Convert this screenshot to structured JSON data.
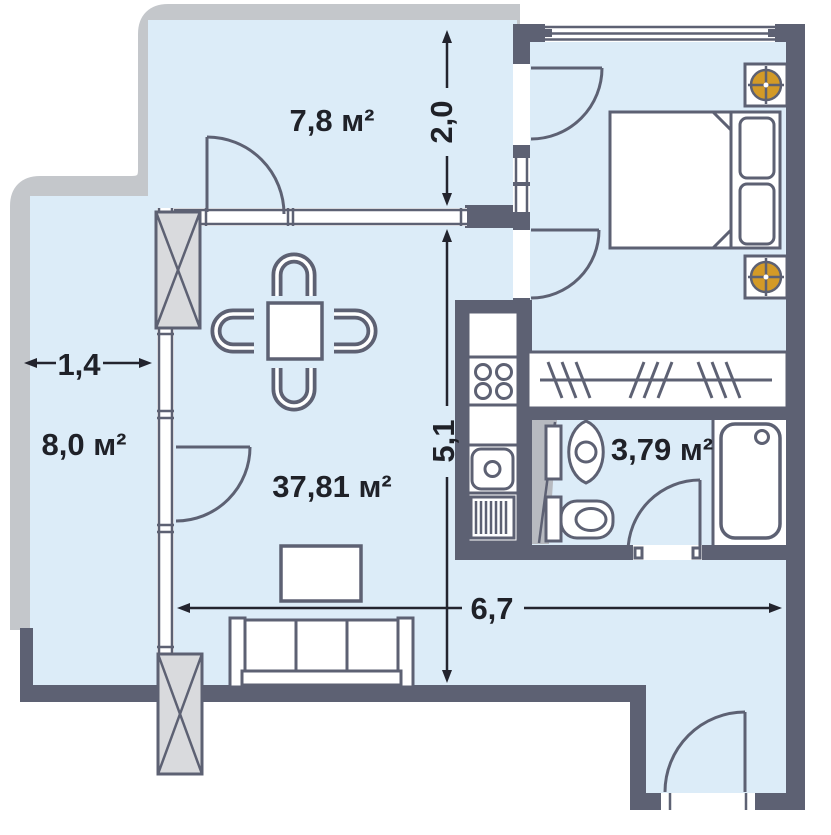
{
  "plan_title": "Apartment floor plan",
  "rooms": [
    {
      "id": "balcony-top",
      "label": "7,8 м²"
    },
    {
      "id": "balcony-left",
      "label": "8,0 м²"
    },
    {
      "id": "living-room",
      "label": "37,81 м²"
    },
    {
      "id": "bathroom",
      "label": "3,79 м²"
    }
  ],
  "dimensions": [
    {
      "id": "balcony-left-width",
      "label": "1,4"
    },
    {
      "id": "balcony-top-depth",
      "label": "2,0"
    },
    {
      "id": "living-room-depth",
      "label": "5,1"
    },
    {
      "id": "living-room-width",
      "label": "6,7"
    }
  ],
  "furniture": [
    "dining-table",
    "chair",
    "sofa",
    "tv-stand",
    "double-bed",
    "pillows",
    "wardrobe-hangers",
    "kitchen-counter",
    "stove-4-burners",
    "kitchen-sink",
    "drainer",
    "washbasin",
    "toilet",
    "bathtub",
    "ventilation-fan",
    "structural-column",
    "balcony-door",
    "entrance-door"
  ],
  "colors": {
    "wall": "#5d6173",
    "floor": "#dcecf8",
    "balcony_outline": "#c4c7cb",
    "column_fill": "#d9dadd",
    "shaft_fill": "#b7bac0",
    "vent": "#d39a27",
    "text": "#1f2128",
    "dim": "#23242e"
  }
}
